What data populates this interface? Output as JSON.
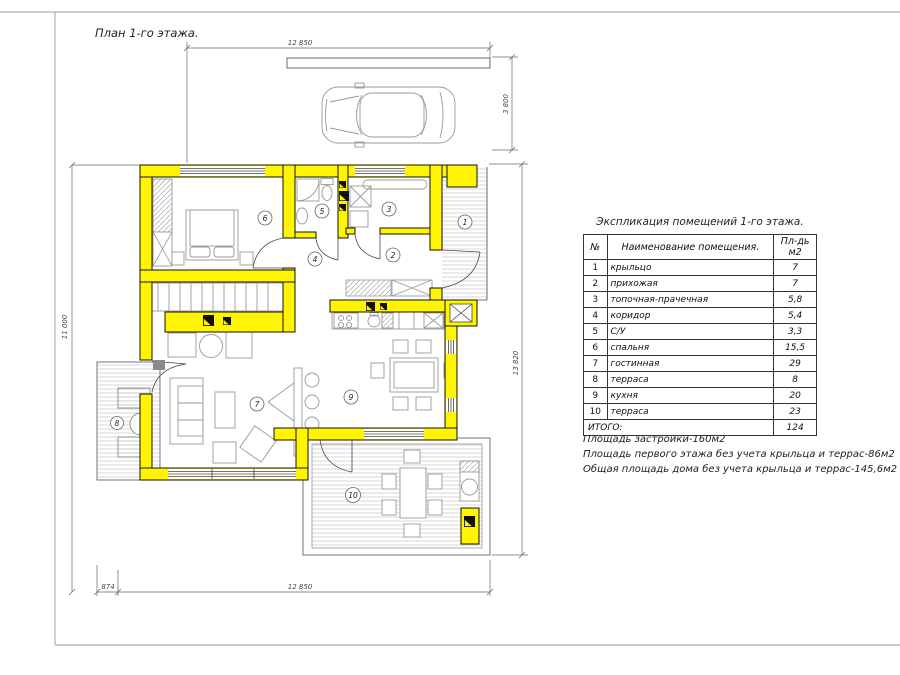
{
  "sheet": {
    "plan_title": "План 1-го этажа."
  },
  "plan": {
    "wall_color": "#FFF500",
    "dimensions": {
      "top": "12 850",
      "parking": "3 800",
      "right": "13 820",
      "left": "11 000",
      "bottom_a": "874",
      "bottom_b": "12 850"
    }
  },
  "legend": {
    "title": "Экспликация помещений 1-го этажа.",
    "col_num": "№",
    "col_name": "Наименование помещения.",
    "col_area1": "Пл-дь",
    "col_area2": "м2",
    "rows": [
      {
        "num": "1",
        "name": "крыльцо",
        "area": "7"
      },
      {
        "num": "2",
        "name": "прихожая",
        "area": "7"
      },
      {
        "num": "3",
        "name": "топочная-прачечная",
        "area": "5,8"
      },
      {
        "num": "4",
        "name": "коридор",
        "area": "5,4"
      },
      {
        "num": "5",
        "name": "С/У",
        "area": "3,3"
      },
      {
        "num": "6",
        "name": "спальня",
        "area": "15,5"
      },
      {
        "num": "7",
        "name": "гостинная",
        "area": "29"
      },
      {
        "num": "8",
        "name": "терраса",
        "area": "8"
      },
      {
        "num": "9",
        "name": "кухня",
        "area": "20"
      },
      {
        "num": "10",
        "name": "терраса",
        "area": "23"
      }
    ],
    "total_label": "ИТОГО:",
    "total_value": "124"
  },
  "notes": [
    "Площадь застройки-160м2",
    "Площадь первого этажа без учета крыльца и террас-86м2",
    "Общая площадь дома без учета крыльца и террас-145,6м2"
  ]
}
